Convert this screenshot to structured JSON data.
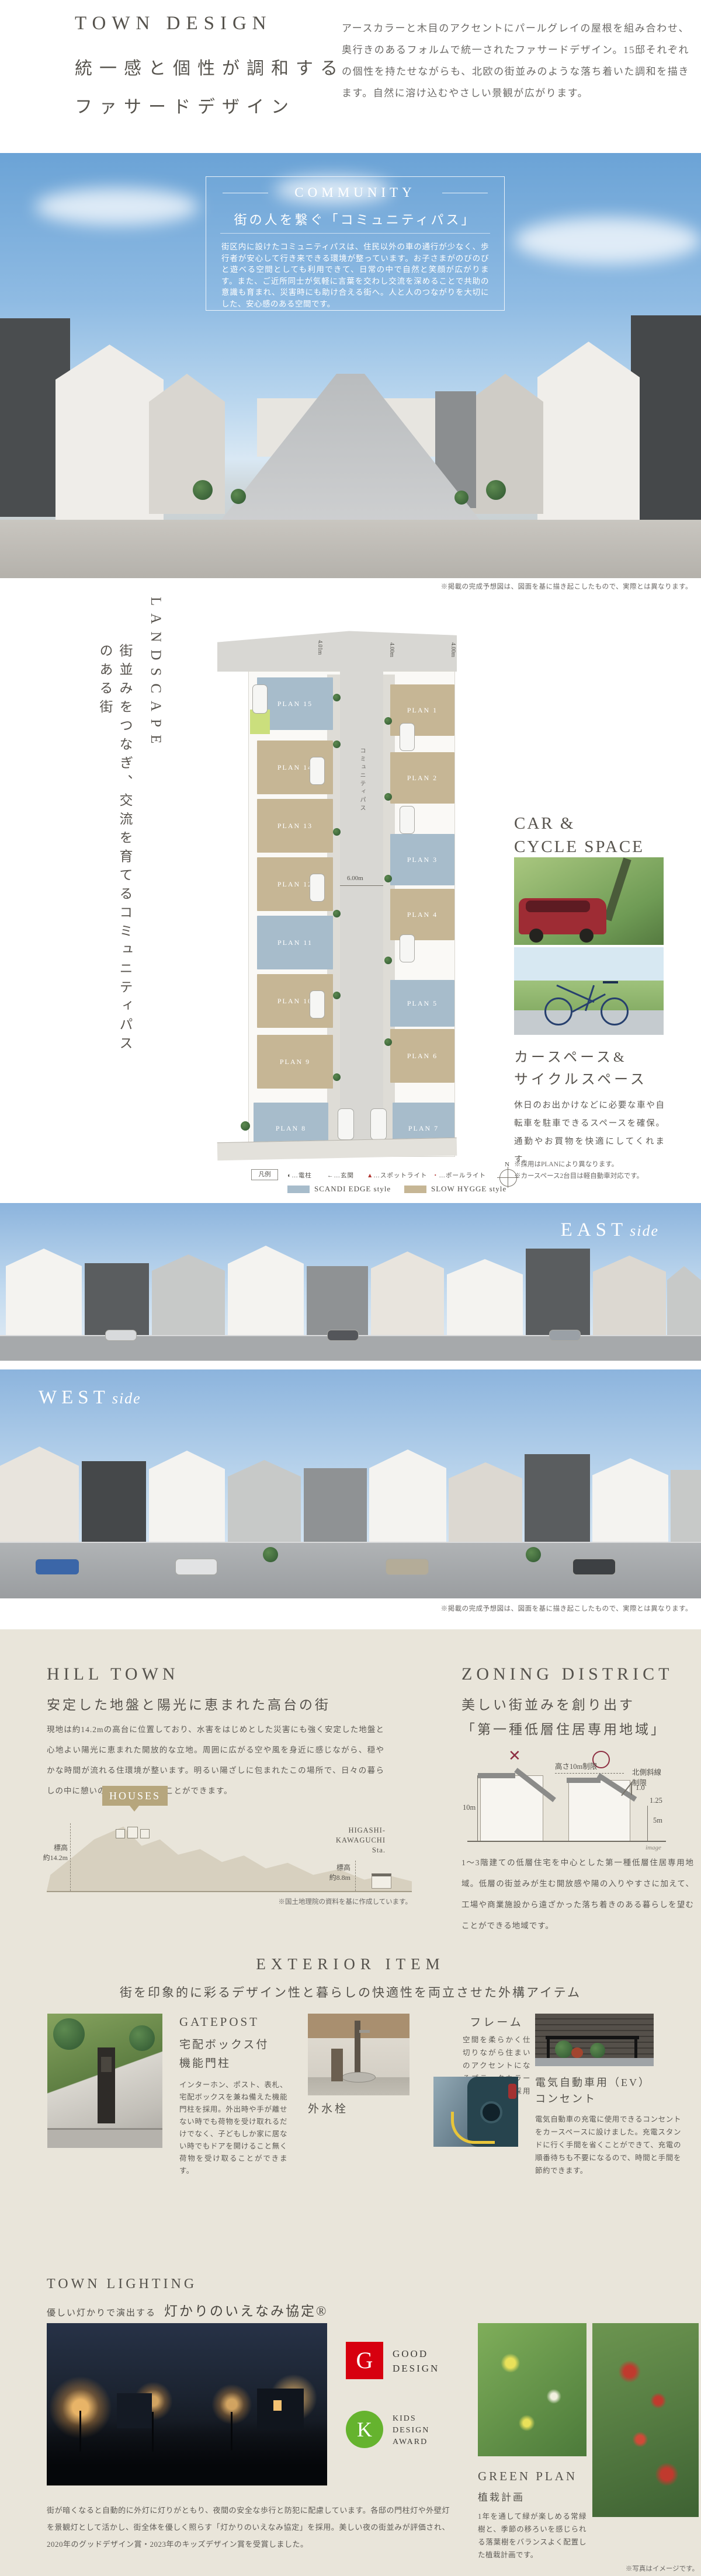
{
  "header": {
    "title": "TOWN DESIGN",
    "subtitle_line1": "統一感と個性が調和する",
    "subtitle_line2": "ファサードデザイン",
    "body": "アースカラーと木目のアクセントにパールグレイの屋根を組み合わせ、奥行きのあるフォルムで統一されたファサードデザイン。15邸それぞれの個性を持たせながらも、北欧の街並みのような落ち着いた調和を描きます。自然に溶け込むやさしい景観が広がります。"
  },
  "community": {
    "heading": "COMMUNITY",
    "subheading": "街の人を繋ぐ「コミュニティパス」",
    "body": "街区内に設けたコミュニティパスは、住民以外の車の通行が少なく、歩行者が安心して行き来できる環境が整っています。お子さまがのびのびと遊べる空間としても利用できて、日常の中で自然と笑顔が広がります。また、ご近所同士が気軽に言葉を交わし交流を深めることで共助の意識も育まれ、災害時にも助け合える街へ。人と人のつながりを大切にした、安心感のある空間です。",
    "caption": "※掲載の完成予想図は、図面を基に描き起こしたもので、実際とは異なります。"
  },
  "landscape": {
    "heading": "LANDSCAPE",
    "vertical_copy": "街並みをつなぎ、交流を育てるコミュニティパスのある街",
    "map": {
      "path_label": "コミュニティパス",
      "trash_label": "ごみ集積所",
      "m1": "4.01m",
      "m2": "4.00m",
      "m3": "4.00m",
      "m4": "6.00m",
      "plots": [
        {
          "label": "PLAN 1"
        },
        {
          "label": "PLAN 2"
        },
        {
          "label": "PLAN 3"
        },
        {
          "label": "PLAN 4"
        },
        {
          "label": "PLAN 5"
        },
        {
          "label": "PLAN 6"
        },
        {
          "label": "PLAN 7"
        },
        {
          "label": "PLAN 8"
        },
        {
          "label": "PLAN 9"
        },
        {
          "label": "PLAN 10"
        },
        {
          "label": "PLAN 11"
        },
        {
          "label": "PLAN 12"
        },
        {
          "label": "PLAN 13"
        },
        {
          "label": "PLAN 14"
        },
        {
          "label": "PLAN 15"
        }
      ],
      "legend": {
        "title": "凡例",
        "items": [
          {
            "glyph": "◐",
            "label": "…電柱"
          },
          {
            "glyph": "←",
            "label": "…玄関"
          },
          {
            "glyph": "▲",
            "label": "…スポットライト"
          },
          {
            "glyph": "・",
            "label": "…ポールライト"
          }
        ],
        "styles": [
          {
            "label": "SCANDI EDGE style",
            "color": "#a7bccb"
          },
          {
            "label": "SLOW HYGGE style",
            "color": "#c6b695"
          }
        ],
        "compass": "N"
      }
    },
    "car_cycle": {
      "heading_line1": "CAR &",
      "heading_line2": "CYCLE SPACE",
      "title_line1": "カースペース&",
      "title_line2": "サイクルスペース",
      "body": "休日のお出かけなどに必要な車や自転車を駐車できるスペースを確保。通勤やお買物を快適にしてくれます。",
      "note1": "※採用はPLANにより異なります。",
      "note2": "※カースペース2台目は軽自動車対応です。"
    }
  },
  "east": {
    "label": "EAST",
    "suffix": "side"
  },
  "west": {
    "label": "WEST",
    "suffix": "side",
    "caption": "※掲載の完成予想図は、図面を基に描き起こしたもので、実際とは異なります。"
  },
  "hill_town": {
    "heading": "HILL TOWN",
    "subheading": "安定した地盤と陽光に恵まれた高台の街",
    "body": "現地は約14.2mの高台に位置しており、水害をはじめとした災害にも強く安定した地盤と心地よい陽光に恵まれた開放的な立地。周囲に広がる空や風を身近に感じながら、穏やかな時間が流れる住環境が整います。明るい陽ざしに包まれたこの場所で、日々の暮らしの中に憩いの時間を満喫することができます。",
    "diagram": {
      "houses_label": "HOUSES",
      "station_line1": "HIGASHI-",
      "station_line2": "KAWAGUCHI",
      "station_line3": "Sta.",
      "elev_left_line1": "標高",
      "elev_left_line2": "約14.2m",
      "elev_right_line1": "標高",
      "elev_right_line2": "約8.8m"
    },
    "footnote": "※国土地理院の資料を基に作成しています。"
  },
  "zoning": {
    "heading": "ZONING DISTRICT",
    "subheading_line1": "美しい街並みを創り出す",
    "subheading_line2": "「第一種低層住居専用地域」",
    "body": "1～3階建ての低層住宅を中心とした第一種低層住居専用地域。低層の街並みが生む開放感や陽の入りやすさに加えて、工場や商業施設から遠ざかった落ち着きのある暮らしを望むことができる地域です。",
    "diagram": {
      "ng_mark": "✕",
      "height_limit": "高さ10m制限",
      "north_line1": "北側斜線",
      "north_line2": "制限",
      "ratio_top": "1.0",
      "ratio_bottom": "1.25",
      "left_height": "10m",
      "right_height": "5m",
      "image_note": "image"
    }
  },
  "exterior": {
    "heading": "EXTERIOR ITEM",
    "subheading": "街を印象的に彩るデザイン性と暮らしの快適性を両立させた外構アイテム",
    "gatepost": {
      "title": "GATEPOST",
      "subtitle_line1": "宅配ボックス付",
      "subtitle_line2": "機能門柱",
      "body": "インターホン、ポスト、表札、宅配ボックスを兼ね備えた機能門柱を採用。外出時や手が離せない時でも荷物を受け取れるだけでなく、子どもしか家に居ない時でもドアを開けること無く荷物を受け取ることができます。"
    },
    "water": {
      "title": "外水栓",
      "body": "植栽の水やりや洗車などに便利な外水栓。住まいに調和するスタイリッシュなデザインを設えました。"
    },
    "frame": {
      "title": "フレーム",
      "body": "空間を柔らかく仕切りながら住まいのアクセントになるブラックカラーのフレームを採用しました。"
    },
    "ev": {
      "title_line1": "電気自動車用（EV）",
      "title_line2": "コンセント",
      "body": "電気自動車の充電に使用できるコンセントをカースペースに設けました。充電スタンドに行く手間を省くことができて、充電の順番待ちも不要になるので、時間と手間を節約できます。"
    }
  },
  "lighting": {
    "heading": "TOWN LIGHTING",
    "sub_small": "優しい灯かりで演出する",
    "sub_large": "灯かりのいえなみ協定®",
    "body": "街が暗くなると自動的に外灯に灯りがともり、夜間の安全な歩行と防犯に配慮しています。各邸の門柱灯や外壁灯を景観灯として活かし、街全体を優しく照らす「灯かりのいえなみ協定」を採用。美しい夜の街並みが評価され、2020年のグッドデザイン賞・2023年のキッズデザイン賞を受賞しました。",
    "good_design": {
      "mark": "G",
      "line1": "GOOD",
      "line2": "DESIGN"
    },
    "kids_design": {
      "mark": "K",
      "line1": "KIDS",
      "line2": "DESIGN",
      "line3": "AWARD"
    }
  },
  "green": {
    "title": "GREEN PLAN",
    "subtitle": "植栽計画",
    "body": "1年を通して緑が楽しめる常緑樹と、季節の移ろいを感じられる落葉樹をバランスよく配置した植栽計画です。",
    "note": "※写真はイメージです。"
  },
  "colors": {
    "scandi": "#a7bccb",
    "hygge": "#c6b695",
    "beige": "#e9e5da",
    "accent": "#8e2f43"
  }
}
